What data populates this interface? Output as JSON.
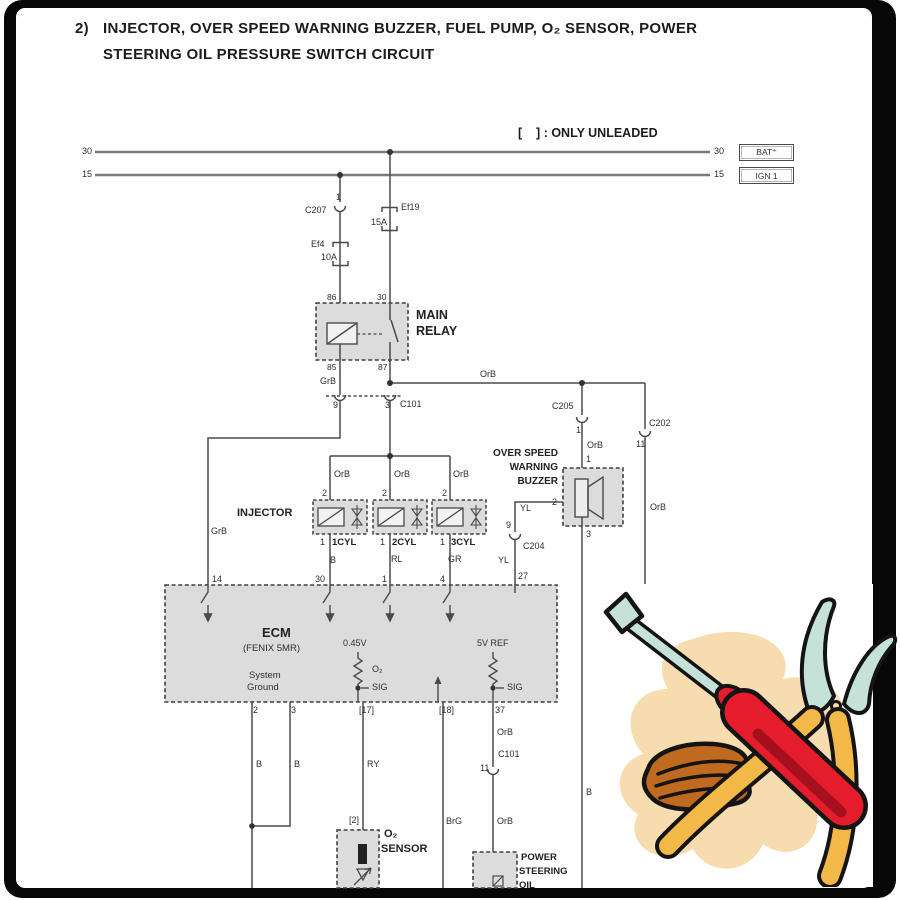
{
  "title": {
    "number": "2)",
    "line1": "INJECTOR, OVER SPEED WARNING BUZZER, FUEL PUMP, O₂ SENSOR, POWER",
    "line2": "STEERING OIL PRESSURE SWITCH CIRCUIT"
  },
  "note": "[    ] : ONLY UNLEADED",
  "rails": {
    "r30": {
      "left": "30",
      "right": "30",
      "term": "BAT⁺"
    },
    "r15": {
      "left": "15",
      "right": "15",
      "term": "IGN 1"
    }
  },
  "fuses": {
    "ef4": {
      "name": "Ef4",
      "rating": "10A"
    },
    "ef19": {
      "name": "Ef19",
      "rating": "15A"
    }
  },
  "conn": {
    "c207": {
      "pin": "1",
      "name": "C207"
    },
    "c101t": {
      "p9": "9",
      "p3": "3",
      "name": "C101"
    },
    "c205": {
      "name": "C205",
      "pin": "1"
    },
    "c202": {
      "name": "C202",
      "pin": "11"
    },
    "c204": {
      "pin": "9",
      "name": "C204"
    },
    "c101m": {
      "name": "C101",
      "pin": "11"
    }
  },
  "relay": {
    "l1": "MAIN",
    "l2": "RELAY",
    "p86": "86",
    "p30": "30",
    "p85": "85",
    "p87": "87"
  },
  "buz": {
    "l1": "OVER SPEED",
    "l2": "WARNING",
    "l3": "BUZZER",
    "p1": "1",
    "p2": "2",
    "p3": "3"
  },
  "inj": {
    "label": "INJECTOR",
    "units": [
      {
        "p2": "2",
        "p1": "1",
        "name": "1CYL",
        "wire": "B"
      },
      {
        "p2": "2",
        "p1": "1",
        "name": "2CYL",
        "wire": "RL"
      },
      {
        "p2": "2",
        "p1": "1",
        "name": "3CYL",
        "wire": "GR"
      }
    ]
  },
  "ecm": {
    "name": "ECM",
    "sub": "(FENIX 5MR)",
    "p14": "14",
    "p30": "30",
    "p1": "1",
    "p4": "4",
    "p27": "27",
    "sys1": "System",
    "sys2": "Ground",
    "v045": "0.45V",
    "o2": "O₂",
    "sigl": "SIG",
    "v5": "5V REF",
    "sigr": "SIG",
    "b2": "2",
    "b3": "3",
    "b17": "[17]",
    "b18": "[18]",
    "b37": "37"
  },
  "o2s": {
    "pin": "[2]",
    "l1": "O₂",
    "l2": "SENSOR"
  },
  "ps": {
    "l1": "POWER",
    "l2": "STEERING",
    "l3": "OIL"
  },
  "wires": {
    "grb1": "GrB",
    "grb2": "GrB",
    "orb_main": "OrB",
    "orb_c205": "OrB",
    "orb_c202": "OrB",
    "orb1": "OrB",
    "orb2": "OrB",
    "orb3": "OrB",
    "yl1": "YL",
    "yl2": "YL",
    "b_buzz": "B",
    "b2": "B",
    "b3": "B",
    "ry": "RY",
    "brg": "BrG",
    "orb37a": "OrB",
    "orb37b": "OrB"
  },
  "colors": {
    "line": "#4a4a4a",
    "bus": "#7a7a7a",
    "box_fill": "#dcdcdc",
    "frame": "#070707",
    "clip_red": "#e51c2c",
    "clip_mint": "#c5e2d9",
    "clip_yellow": "#f2b848",
    "clip_brown": "#bf6a1e",
    "clip_cream": "#f6dcae"
  }
}
